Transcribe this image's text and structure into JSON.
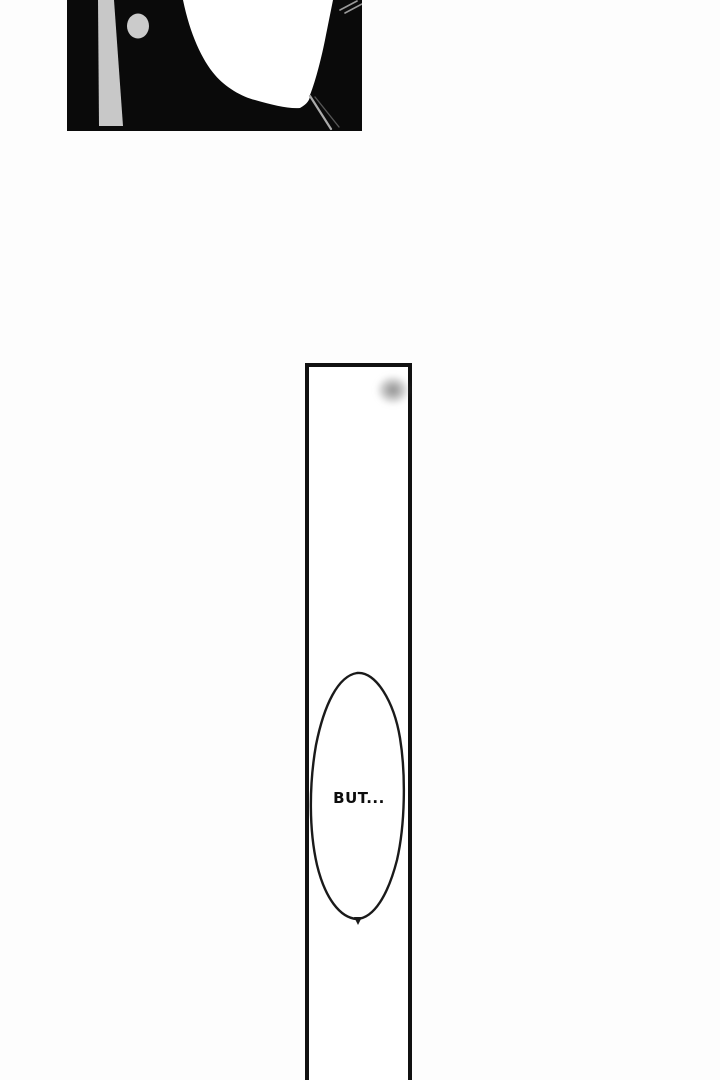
{
  "speech_bubble": {
    "text": "BUT..."
  },
  "colors": {
    "paper": "#fdfdfd",
    "ink": "#0a0a0a",
    "white": "#ffffff",
    "panel_border": "#111111",
    "art_gray_bar": "#c8c8c8",
    "art_gray_dot": "#cbcbcb",
    "streak_light": "#9a9a9a",
    "streak_bright": "#ababab",
    "streak_dim": "#555555",
    "bubble_stroke": "#1a1a1a",
    "smudge_gray": "#8c8c8c"
  }
}
